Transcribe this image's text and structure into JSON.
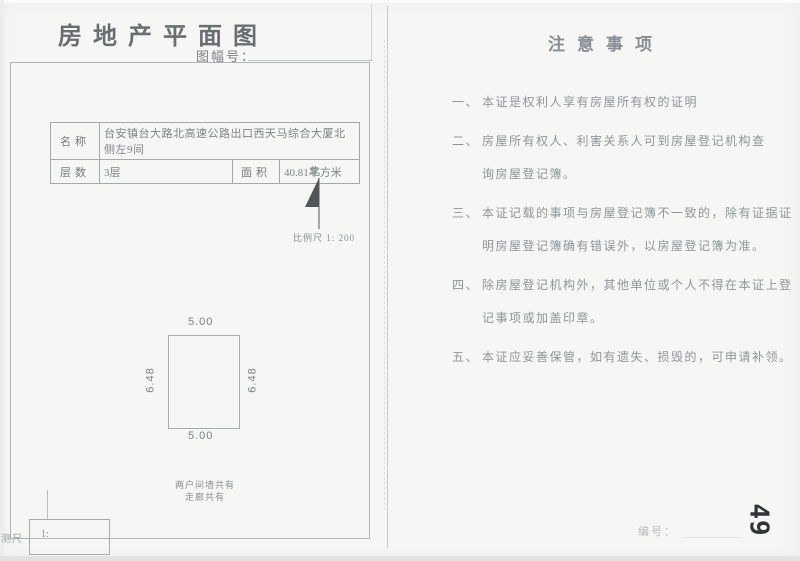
{
  "left_page": {
    "title": "房地产平面图",
    "sheet_no_label": "图幅号：",
    "info_table": {
      "name_label": "名称",
      "name_value": "台安镇台大路北高速公路出口西天马综合大厦北侧左9间",
      "floors_label": "层数",
      "floors_value": "3层",
      "area_label": "面积",
      "area_value": "40.81平方米"
    },
    "north_label": "北",
    "scale_label": "比例尺 1: 200",
    "plot_dimensions": {
      "top": "5.00",
      "bottom": "5.00",
      "left": "6.48",
      "right": "6.48"
    },
    "plan_note_line1": "两户间墙共有",
    "plan_note_line2": "走廊共有",
    "corner_label": "测尺",
    "corner_value": "1:"
  },
  "right_page": {
    "title": "注意事项",
    "items": [
      {
        "num": "一、",
        "lines": [
          "本证是权利人享有房屋所有权的证明"
        ]
      },
      {
        "num": "二、",
        "lines": [
          "房屋所有权人、利害关系人可到房屋登记机构查",
          "询房屋登记簿。"
        ]
      },
      {
        "num": "三、",
        "lines": [
          "本证记载的事项与房屋登记簿不一致的，除有证据证",
          "明房屋登记簿确有错误外，以房屋登记簿为准。"
        ]
      },
      {
        "num": "四、",
        "lines": [
          "除房屋登记机构外，其他单位或个人不得在本证上登",
          "记事项或加盖印章。"
        ]
      },
      {
        "num": "五、",
        "lines": [
          "本证应妥善保管，如有遗失、损毁的，可申请补领。"
        ]
      }
    ],
    "serial_label": "编号：",
    "page_number": "49"
  },
  "colors": {
    "paper": "#f6f6f4",
    "ink_dark": "#686e73",
    "ink_light": "#8d969d",
    "line": "#a9acae",
    "page_number": "#303437"
  }
}
